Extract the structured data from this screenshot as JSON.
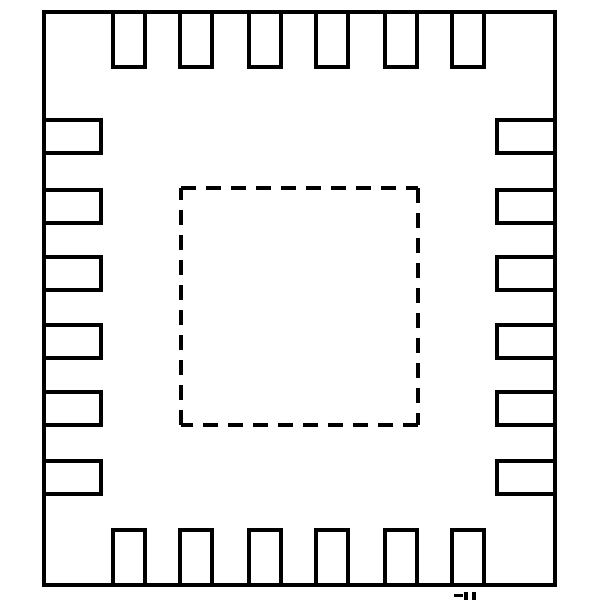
{
  "diagram": {
    "title": "QFN package footprint outline",
    "type": "ic-package-land-pattern",
    "background_color": "#ffffff",
    "line_color": "#000000",
    "stroke_width": 4,
    "canvas": {
      "width": 600,
      "height": 600
    },
    "body_outline": {
      "x": 44,
      "y": 12,
      "width": 511,
      "height": 573
    },
    "exposed_pad": {
      "x": 181,
      "y": 188,
      "width": 237,
      "height": 237,
      "dash_on": 15,
      "dash_off": 10,
      "style": "dashed"
    },
    "pins": {
      "total_count": 24,
      "per_side": 6,
      "top": {
        "y": 12,
        "width": 32,
        "height": 55,
        "x_positions": [
          113,
          180,
          249,
          316,
          385,
          452
        ]
      },
      "bottom": {
        "y": 530,
        "width": 32,
        "height": 55,
        "x_positions": [
          113,
          180,
          249,
          316,
          385,
          452
        ]
      },
      "left": {
        "x": 44,
        "width": 57,
        "height": 33,
        "y_positions": [
          120,
          190,
          257,
          325,
          392,
          461
        ]
      },
      "right": {
        "x": 497,
        "width": 58,
        "height": 33,
        "y_positions": [
          120,
          190,
          257,
          325,
          392,
          461
        ]
      }
    },
    "clipped_text_artifact": {
      "description": "partial glyph tops clipped by bottom image edge",
      "marks": [
        {
          "x": 454,
          "y": 594,
          "width": 9,
          "height": 3
        },
        {
          "x": 464,
          "y": 592,
          "width": 4,
          "height": 8
        },
        {
          "x": 472,
          "y": 592,
          "width": 4,
          "height": 8
        }
      ]
    }
  }
}
